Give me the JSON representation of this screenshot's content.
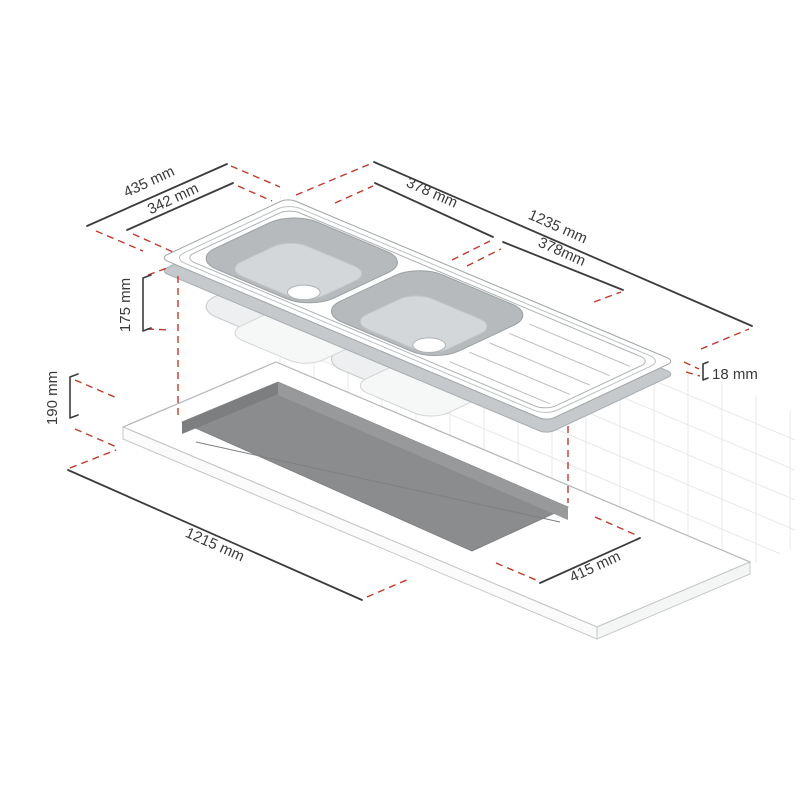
{
  "diagram": {
    "unit": "mm",
    "dimensions": {
      "sink_width_outer": "435 mm",
      "sink_width_inner": "342 mm",
      "bowl_left_length": "378 mm",
      "sink_length": "1235 mm",
      "bowl_right_length": "378mm",
      "bowl_depth": "175 mm",
      "edge_thickness": "18 mm",
      "cutout_front_offset": "190 mm",
      "cutout_length": "1215 mm",
      "cutout_width": "415 mm"
    },
    "colors": {
      "dimension_line": "#3c3c3c",
      "extension_red": "#c13a2d",
      "label_text": "#3a3a3a",
      "bowl_wall": "#b6babc",
      "bowl_floor": "#d4d7d9",
      "cutout_fill": "#8a8c8e",
      "tile_line": "#e8e8e8"
    }
  }
}
